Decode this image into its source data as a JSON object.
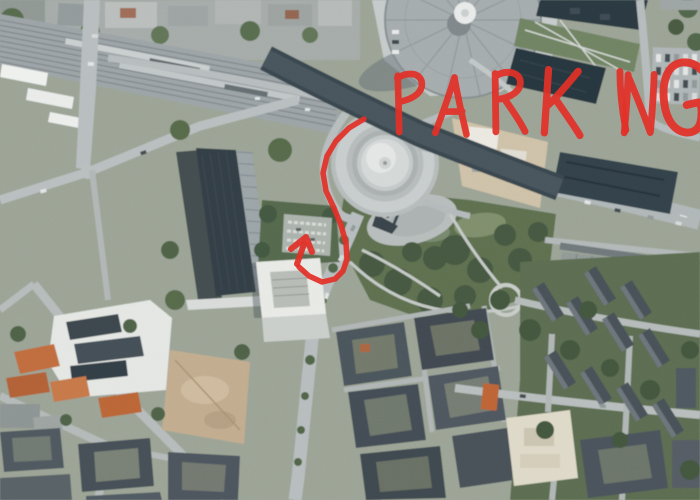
{
  "annotation": {
    "label_text": "PARKING",
    "marker_color": "#e23028",
    "label_layout": {
      "baseline_y": 134,
      "letter_x": [
        388,
        436,
        487,
        540,
        600,
        622,
        660
      ],
      "letter_height": [
        60,
        60,
        62,
        66,
        62,
        62,
        72
      ],
      "letter_rot": [
        -4,
        3,
        -2,
        2,
        -7,
        2,
        -2
      ]
    },
    "route_points": [
      [
        364,
        119
      ],
      [
        349,
        128
      ],
      [
        336,
        141
      ],
      [
        327,
        156
      ],
      [
        323,
        173
      ],
      [
        326,
        191
      ],
      [
        334,
        208
      ],
      [
        341,
        225
      ],
      [
        346,
        243
      ],
      [
        347,
        259
      ],
      [
        343,
        271
      ],
      [
        335,
        279
      ],
      [
        322,
        282
      ],
      [
        309,
        276
      ],
      [
        299,
        267
      ]
    ],
    "arrow": {
      "shaft_from": [
        297,
        264
      ],
      "shaft_to": [
        304,
        244
      ],
      "tip": [
        306,
        237
      ],
      "barb_left": [
        291,
        249
      ],
      "barb_right": [
        312,
        252
      ]
    }
  }
}
